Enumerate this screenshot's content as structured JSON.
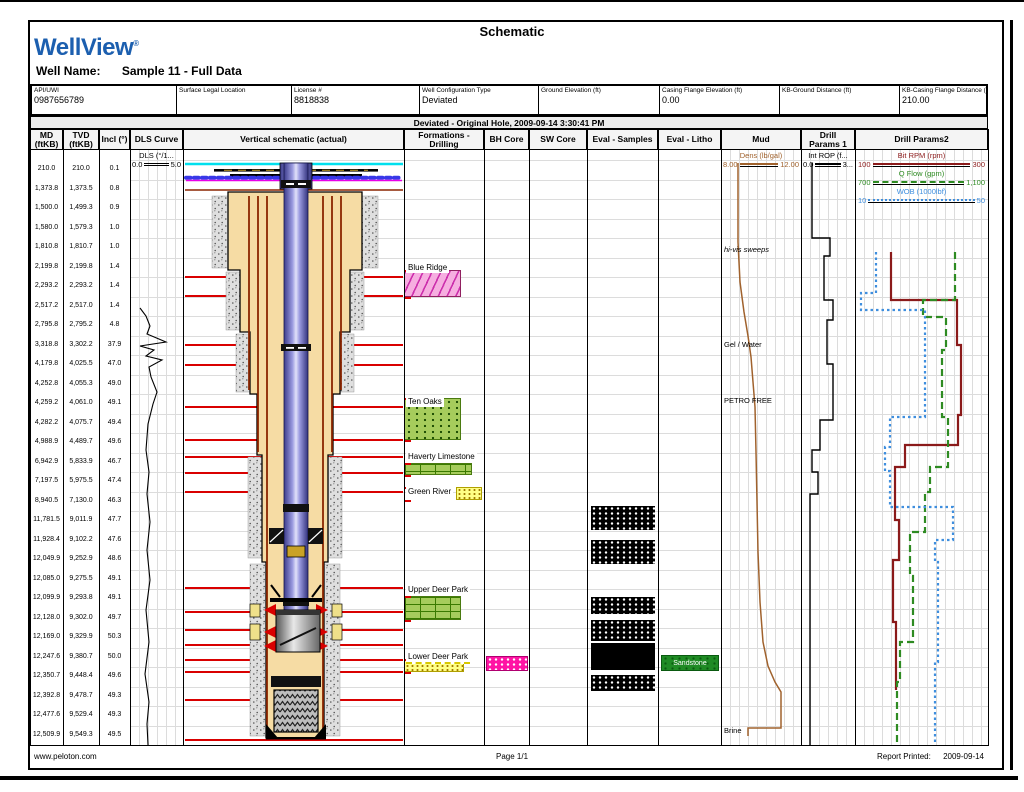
{
  "report": {
    "title": "Schematic",
    "app": "WellView",
    "app_mark": "®",
    "well_name_label": "Well Name:",
    "well_name": "Sample 11 - Full Data",
    "banner": "Deviated - Original Hole, 2009-09-14 3:30:41 PM",
    "footer_left": "www.peloton.com",
    "footer_center": "Page 1/1",
    "footer_right_label": "Report Printed:",
    "footer_right_value": "2009-09-14"
  },
  "info_fields": [
    {
      "label": "API/UWI",
      "value": "0987656789"
    },
    {
      "label": "Surface Legal Location",
      "value": ""
    },
    {
      "label": "License #",
      "value": "8818838"
    },
    {
      "label": "Well Configuration Type",
      "value": "Deviated"
    },
    {
      "label": "Ground Elevation (ft)",
      "value": ""
    },
    {
      "label": "Casing Flange Elevation (ft)",
      "value": "0.00"
    },
    {
      "label": "KB-Ground Distance (ft)",
      "value": ""
    },
    {
      "label": "KB-Casing Flange Distance (ft)",
      "value": "210.00"
    }
  ],
  "columns": [
    {
      "label": "MD\n(ftKB)"
    },
    {
      "label": "TVD\n(ftKB)"
    },
    {
      "label": "Incl (°)"
    },
    {
      "label": "DLS Curve"
    },
    {
      "label": "Vertical schematic (actual)"
    },
    {
      "label": "Formations -\nDrilling"
    },
    {
      "label": "BH Core"
    },
    {
      "label": "SW Core"
    },
    {
      "label": "Eval - Samples"
    },
    {
      "label": "Eval - Litho"
    },
    {
      "label": "Mud"
    },
    {
      "label": "Drill\nParams 1"
    },
    {
      "label": "Drill Params2"
    }
  ],
  "legends": {
    "dls": {
      "title": "DLS (°/1...",
      "min": "0.0",
      "max": "5.0",
      "color": "#000000",
      "style": "double"
    },
    "mud": {
      "title": "Dens (lb/gal)",
      "min": "8.00",
      "max": "12.00",
      "color": "#A0622D",
      "style": "solid"
    },
    "dp1": {
      "title": "Int ROP (f...",
      "min": "0.0",
      "max": "3...",
      "color": "#000000",
      "style": "solid"
    },
    "dp2": [
      {
        "title": "Bit RPM (rpm)",
        "min": "100",
        "max": "300",
        "color": "#8B1A1A",
        "style": "solid"
      },
      {
        "title": "Q Flow (gpm)",
        "min": "700",
        "max": "1,100",
        "color": "#2E8B22",
        "style": "dashed"
      },
      {
        "title": "WOB (1000lbf)",
        "min": "10",
        "max": "50",
        "color": "#3E8EDE",
        "style": "dotted"
      }
    ]
  },
  "chart_data": {
    "type": "well-log-schematic",
    "survey_columns": [
      "MD (ftKB)",
      "TVD (ftKB)",
      "Incl (°)"
    ],
    "survey_rows": [
      [
        "210.0",
        "210.0",
        "0.1"
      ],
      [
        "1,373.8",
        "1,373.5",
        "0.8"
      ],
      [
        "1,500.0",
        "1,499.3",
        "0.9"
      ],
      [
        "1,580.0",
        "1,579.3",
        "1.0"
      ],
      [
        "1,810.8",
        "1,810.7",
        "1.0"
      ],
      [
        "2,199.8",
        "2,199.8",
        "1.4"
      ],
      [
        "2,293.2",
        "2,293.2",
        "1.4"
      ],
      [
        "2,517.2",
        "2,517.0",
        "1.4"
      ],
      [
        "2,795.8",
        "2,795.2",
        "4.8"
      ],
      [
        "3,318.8",
        "3,302.2",
        "37.9"
      ],
      [
        "4,179.8",
        "4,025.5",
        "47.0"
      ],
      [
        "4,252.8",
        "4,055.3",
        "49.0"
      ],
      [
        "4,259.2",
        "4,061.0",
        "49.1"
      ],
      [
        "4,282.2",
        "4,075.7",
        "49.4"
      ],
      [
        "4,988.9",
        "4,489.7",
        "49.6"
      ],
      [
        "6,942.9",
        "5,833.9",
        "46.7"
      ],
      [
        "7,197.5",
        "5,975.5",
        "47.4"
      ],
      [
        "8,940.5",
        "7,130.0",
        "46.3"
      ],
      [
        "11,781.5",
        "9,011.9",
        "47.7"
      ],
      [
        "11,928.4",
        "9,102.2",
        "47.6"
      ],
      [
        "12,049.9",
        "9,252.9",
        "48.6"
      ],
      [
        "12,085.0",
        "9,275.5",
        "49.1"
      ],
      [
        "12,099.9",
        "9,293.8",
        "49.1"
      ],
      [
        "12,128.0",
        "9,302.0",
        "49.7"
      ],
      [
        "12,169.0",
        "9,329.9",
        "50.3"
      ],
      [
        "12,247.6",
        "9,380.7",
        "50.0"
      ],
      [
        "12,350.7",
        "9,448.4",
        "49.6"
      ],
      [
        "12,392.8",
        "9,478.7",
        "49.3"
      ],
      [
        "12,477.6",
        "9,529.4",
        "49.3"
      ],
      [
        "12,509.9",
        "9,549.3",
        "49.5"
      ]
    ],
    "formations": [
      {
        "name": "Blue Ridge",
        "pattern": "pink",
        "label_x": 406,
        "label_y": 262,
        "band": {
          "x": 404,
          "y": 270,
          "w": 57,
          "h": 27
        }
      },
      {
        "name": "Ten Oaks",
        "pattern": "gdots",
        "label_x": 406,
        "label_y": 396,
        "band": {
          "x": 404,
          "y": 398,
          "w": 57,
          "h": 42
        }
      },
      {
        "name": "Haverty Limestone",
        "pattern": "brick",
        "label_x": 406,
        "label_y": 451,
        "band": {
          "x": 404,
          "y": 463,
          "w": 68,
          "h": 12
        }
      },
      {
        "name": "Green River",
        "pattern": "ydots",
        "label_x": 406,
        "label_y": 486,
        "band": {
          "x": 456,
          "y": 487,
          "w": 26,
          "h": 13
        }
      },
      {
        "name": "Upper Deer Park",
        "pattern": "brick",
        "label_x": 406,
        "label_y": 584,
        "band": {
          "x": 404,
          "y": 596,
          "w": 57,
          "h": 24
        }
      },
      {
        "name": "Lower Deer Park",
        "pattern": "ydots",
        "label_x": 406,
        "label_y": 651,
        "underline": true,
        "band": {
          "x": 404,
          "y": 659,
          "w": 60,
          "h": 13
        }
      }
    ],
    "bh_core_bands": [
      {
        "x": 486,
        "y": 656,
        "w": 42,
        "h": 15
      }
    ],
    "eval_samples_bands": [
      {
        "y": 506,
        "h": 24,
        "solid": false
      },
      {
        "y": 540,
        "h": 24,
        "solid": false
      },
      {
        "y": 597,
        "h": 17,
        "solid": false
      },
      {
        "y": 620,
        "h": 21,
        "solid": false
      },
      {
        "y": 643,
        "h": 27,
        "solid": true
      },
      {
        "y": 675,
        "h": 16,
        "solid": false
      }
    ],
    "eval_litho_bands": [
      {
        "x": 661,
        "y": 655,
        "w": 58,
        "h": 16,
        "label": "Sandstone"
      }
    ],
    "mud_annotations": [
      {
        "text": "hi-vis sweeps",
        "y": 245,
        "italic": true
      },
      {
        "text": "Gel / Water",
        "y": 340,
        "italic": false
      },
      {
        "text": "PETRO FREE",
        "y": 396,
        "italic": false
      },
      {
        "text": "Brine",
        "y": 726,
        "italic": false
      }
    ],
    "marker_lines_y": [
      277,
      296,
      345,
      365,
      407,
      440,
      457,
      473,
      492,
      588,
      612,
      630,
      645,
      660,
      672,
      700,
      740
    ],
    "formation_tick_y": [
      270,
      297,
      398,
      440,
      463,
      475,
      487,
      500,
      596,
      620,
      659,
      672
    ],
    "marker_color": "#D90000",
    "curves": [
      {
        "name": "DLS",
        "track": "DLS Curve",
        "color": "#000000",
        "width": 1.1,
        "dash": "",
        "points": [
          [
            140,
            308
          ],
          [
            146,
            316
          ],
          [
            150,
            326
          ],
          [
            147,
            334
          ],
          [
            166,
            342
          ],
          [
            140,
            346
          ],
          [
            154,
            350
          ],
          [
            146,
            356
          ],
          [
            162,
            360
          ],
          [
            149,
            367
          ],
          [
            151,
            377
          ],
          [
            157,
            392
          ],
          [
            153,
            404
          ],
          [
            148,
            424
          ],
          [
            146,
            450
          ],
          [
            149,
            472
          ],
          [
            147,
            494
          ],
          [
            150,
            522
          ],
          [
            147,
            550
          ],
          [
            150,
            580
          ],
          [
            146,
            610
          ],
          [
            149,
            642
          ],
          [
            145,
            674
          ],
          [
            149,
            702
          ],
          [
            147,
            724
          ],
          [
            148,
            745
          ]
        ]
      },
      {
        "name": "Mud Density",
        "track": "Mud",
        "color": "#A0622D",
        "width": 1.5,
        "dash": "",
        "points": [
          [
            738,
            163
          ],
          [
            738,
            242
          ],
          [
            740,
            282
          ],
          [
            744,
            312
          ],
          [
            748,
            336
          ],
          [
            751,
            357
          ],
          [
            753,
            382
          ],
          [
            755,
            407
          ],
          [
            756,
            452
          ],
          [
            757,
            502
          ],
          [
            758,
            552
          ],
          [
            760,
            602
          ],
          [
            763,
            642
          ],
          [
            768,
            666
          ],
          [
            775,
            682
          ],
          [
            781,
            692
          ],
          [
            781,
            728
          ],
          [
            748,
            728
          ],
          [
            748,
            736
          ]
        ]
      },
      {
        "name": "Int ROP",
        "track": "Drill Params 1",
        "color": "#000000",
        "width": 1.4,
        "dash": "",
        "points": [
          [
            812,
            163
          ],
          [
            812,
            238
          ],
          [
            830,
            238
          ],
          [
            830,
            256
          ],
          [
            824,
            256
          ],
          [
            824,
            300
          ],
          [
            833,
            300
          ],
          [
            833,
            320
          ],
          [
            827,
            320
          ],
          [
            827,
            364
          ],
          [
            833,
            364
          ],
          [
            833,
            420
          ],
          [
            820,
            420
          ],
          [
            820,
            450
          ],
          [
            812,
            450
          ],
          [
            812,
            472
          ],
          [
            818,
            472
          ],
          [
            818,
            494
          ],
          [
            810,
            494
          ],
          [
            810,
            745
          ]
        ]
      },
      {
        "name": "Bit RPM",
        "track": "Drill Params2",
        "color": "#8B1A1A",
        "width": 2.2,
        "dash": "",
        "points": [
          [
            891,
            252
          ],
          [
            891,
            300
          ],
          [
            957,
            300
          ],
          [
            957,
            345
          ],
          [
            961,
            345
          ],
          [
            961,
            415
          ],
          [
            958,
            415
          ],
          [
            958,
            445
          ],
          [
            905,
            445
          ],
          [
            905,
            467
          ],
          [
            895,
            467
          ],
          [
            895,
            520
          ],
          [
            899,
            520
          ],
          [
            899,
            560
          ],
          [
            893,
            560
          ],
          [
            893,
            622
          ],
          [
            896,
            622
          ],
          [
            896,
            690
          ]
        ]
      },
      {
        "name": "Q Flow",
        "track": "Drill Params2",
        "color": "#2E8B22",
        "width": 2.2,
        "dash": "7,4",
        "points": [
          [
            955,
            252
          ],
          [
            955,
            300
          ],
          [
            923,
            300
          ],
          [
            923,
            317
          ],
          [
            946,
            317
          ],
          [
            946,
            350
          ],
          [
            942,
            350
          ],
          [
            942,
            417
          ],
          [
            948,
            417
          ],
          [
            948,
            467
          ],
          [
            930,
            467
          ],
          [
            930,
            492
          ],
          [
            925,
            492
          ],
          [
            925,
            532
          ],
          [
            910,
            532
          ],
          [
            910,
            576
          ],
          [
            913,
            576
          ],
          [
            913,
            642
          ],
          [
            900,
            642
          ],
          [
            900,
            682
          ],
          [
            897,
            682
          ],
          [
            897,
            745
          ]
        ]
      },
      {
        "name": "WOB",
        "track": "Drill Params2",
        "color": "#3E8EDE",
        "width": 2.2,
        "dash": "2.5,3",
        "points": [
          [
            876,
            252
          ],
          [
            876,
            293
          ],
          [
            861,
            293
          ],
          [
            861,
            310
          ],
          [
            925,
            310
          ],
          [
            925,
            417
          ],
          [
            890,
            417
          ],
          [
            890,
            447
          ],
          [
            885,
            447
          ],
          [
            885,
            471
          ],
          [
            890,
            471
          ],
          [
            890,
            507
          ],
          [
            953,
            507
          ],
          [
            953,
            540
          ],
          [
            935,
            540
          ],
          [
            935,
            562
          ],
          [
            938,
            562
          ],
          [
            938,
            662
          ],
          [
            935,
            662
          ],
          [
            935,
            745
          ]
        ]
      }
    ]
  }
}
